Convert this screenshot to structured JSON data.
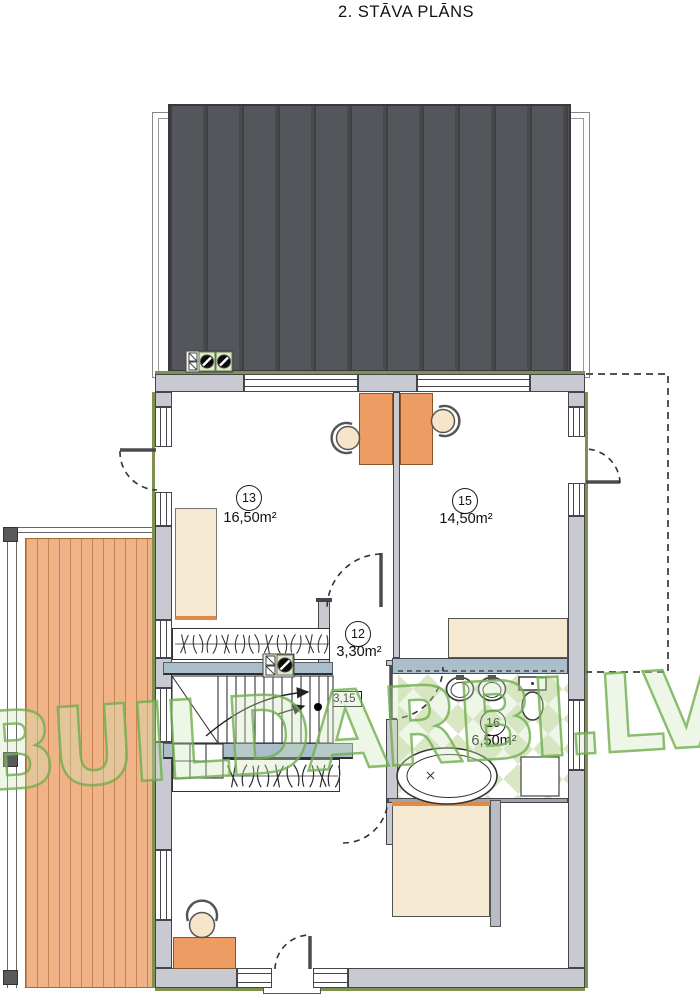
{
  "title": "2. STĀVA PLĀNS",
  "watermark": "BUILDARBI.LV",
  "level_marker": "+3,15",
  "rooms": {
    "r13": {
      "number": "13",
      "area": "16,50m²"
    },
    "r15": {
      "number": "15",
      "area": "14,50m²"
    },
    "r12": {
      "number": "12",
      "area": "3,30m²"
    },
    "r16": {
      "number": "16",
      "area": "6,50m²"
    }
  },
  "colors": {
    "roof": "#55565b",
    "wall": "#c9c9d1",
    "deck": "#f0b287",
    "furniture_cream": "#f5e9d2",
    "accent_orange": "#ed9d63",
    "counter_blue": "#a9bdcb",
    "tile_green": "#d9e7c3",
    "watermark_green": "#6fae4d",
    "exterior_insulation": "#7e9151"
  }
}
